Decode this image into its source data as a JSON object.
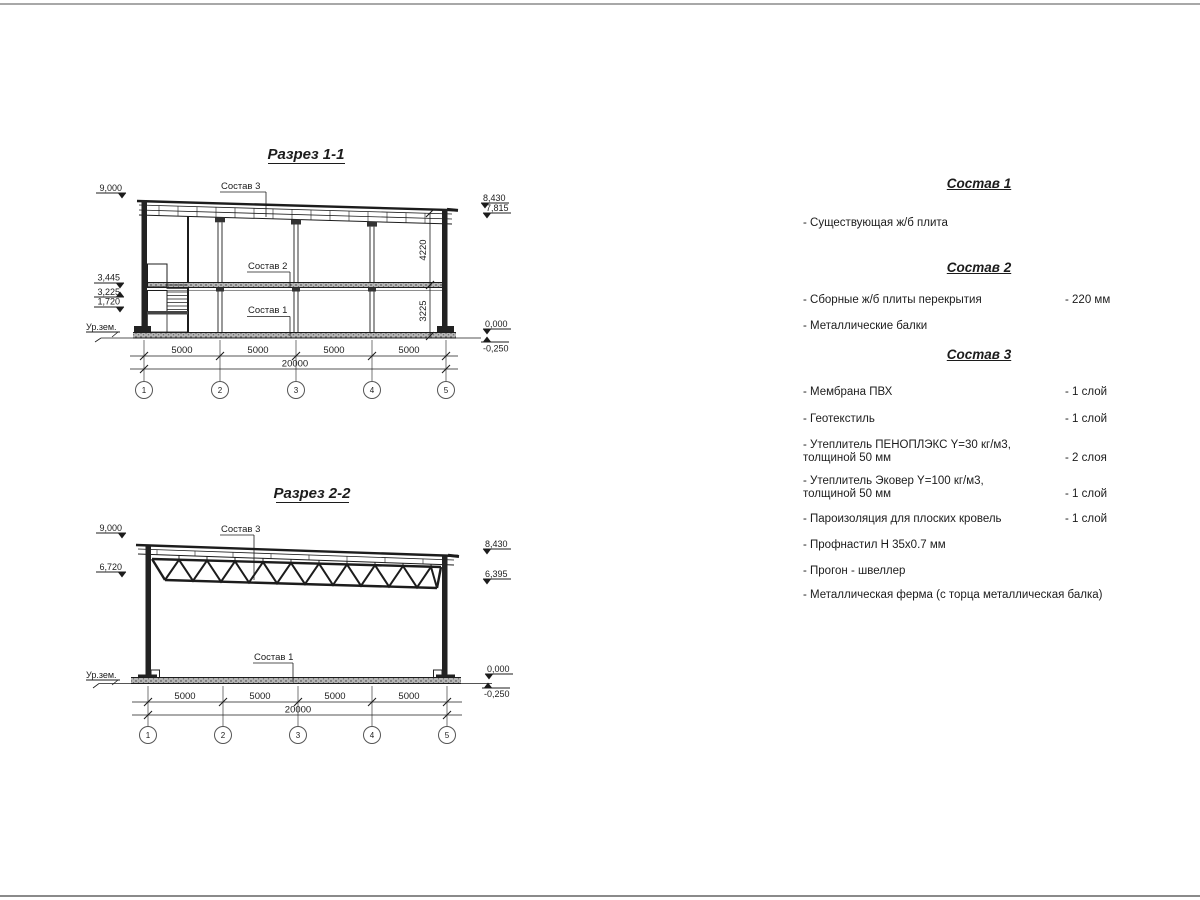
{
  "page": {
    "background": "#ffffff",
    "line_color": "#1c1c1c"
  },
  "section1": {
    "title": "Разрез 1-1",
    "leaders": {
      "sostav3": "Состав 3",
      "sostav2": "Состав 2",
      "sostav1": "Состав 1"
    },
    "elevations": {
      "left": [
        "9,000",
        "3,445",
        "3,225",
        "1,720"
      ],
      "ground": "Ур.зем.",
      "right": [
        "8,430",
        "7,815",
        "0,000",
        "-0,250"
      ]
    },
    "vdims": [
      "4220",
      "3225"
    ],
    "dims": [
      "5000",
      "5000",
      "5000",
      "5000"
    ],
    "total": "20000",
    "axes": [
      "1",
      "2",
      "3",
      "4",
      "5"
    ]
  },
  "section2": {
    "title": "Разрез 2-2",
    "leaders": {
      "sostav3": "Состав 3",
      "sostav1": "Состав 1"
    },
    "elevations": {
      "left": [
        "9,000",
        "6,720"
      ],
      "ground": "Ур.зем.",
      "right": [
        "8,430",
        "6,395",
        "0,000",
        "-0,250"
      ]
    },
    "dims": [
      "5000",
      "5000",
      "5000",
      "5000"
    ],
    "total": "20000",
    "axes": [
      "1",
      "2",
      "3",
      "4",
      "5"
    ]
  },
  "lists": [
    {
      "title": "Состав 1",
      "items": [
        {
          "name": "- Существующая ж/б плита",
          "qty": ""
        }
      ]
    },
    {
      "title": "Состав 2",
      "items": [
        {
          "name": "- Сборные ж/б плиты перекрытия",
          "qty": "- 220 мм"
        },
        {
          "name": "- Металлические балки",
          "qty": ""
        }
      ]
    },
    {
      "title": "Состав 3",
      "items": [
        {
          "name": "- Мембрана ПВХ",
          "qty": "- 1 слой"
        },
        {
          "name": "- Геотекстиль",
          "qty": "- 1 слой"
        },
        {
          "name": "- Утеплитель ПЕНОПЛЭКС Y=30 кг/м3,\nтолщиной 50 мм",
          "qty": "- 2 слоя"
        },
        {
          "name": "- Утеплитель Эковер Y=100 кг/м3,\nтолщиной 50 мм",
          "qty": "- 1 слой"
        },
        {
          "name": "- Пароизоляция для плоских кровель",
          "qty": "- 1 слой"
        },
        {
          "name": "- Профнастил Н 35х0.7 мм",
          "qty": ""
        },
        {
          "name": "- Прогон - швеллер",
          "qty": ""
        },
        {
          "name": "- Металлическая ферма (с торца металлическая балка)",
          "qty": ""
        }
      ]
    }
  ]
}
